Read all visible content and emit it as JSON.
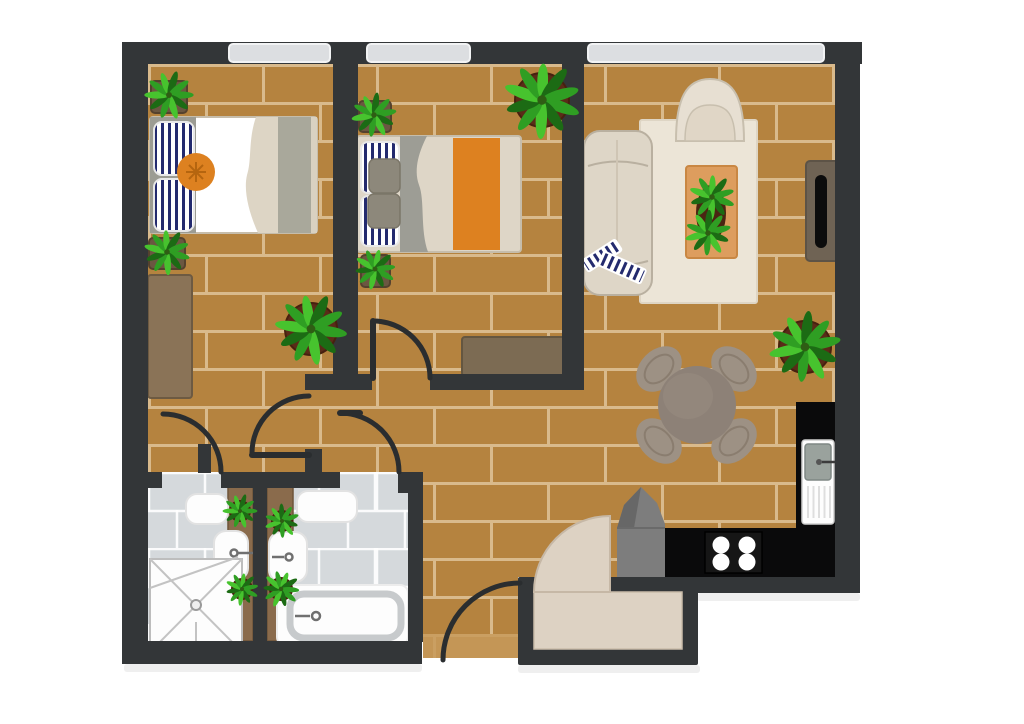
{
  "meta": {
    "title": "Apartment floor plan",
    "type": "top-down illustrated floor plan, no text labels",
    "canvas": {
      "width": 1024,
      "height": 724
    }
  },
  "colors": {
    "wall": "#333638",
    "doorArc": "#2a2d2f",
    "counter": "#0a0a0b",
    "floor": "#b5833f",
    "grout": "#d9ba8c",
    "entryPatch": "#c79a5b",
    "tile": "#d5d9dc",
    "tileLine": "#ffffff",
    "window": "#dcdee1",
    "cream": "#ded6c7",
    "creamLight": "#ece5d7",
    "beige": "#ddd2c3",
    "navy": "#232a6e",
    "orange": "#dd8120",
    "orangeDark": "#b5650f",
    "grayBand": "#a9a89b",
    "headboard": "#9c9c93",
    "bedGray": "#9d9d95",
    "squarePillow": "#8d887b",
    "woodDark": "#6f6354",
    "woodMid": "#7c6b53",
    "woodDresser": "#8a7357",
    "woodStrip": "#8a6b4c",
    "tableTop": "#8d8177",
    "chair": "#9d9184",
    "chairLine": "#8a7d6f",
    "potBrown": "#6b5741",
    "potClay": "#5a2b18",
    "leafDark": "#1c6b14",
    "leafMid": "#2f9e23",
    "leafLight": "#47c32e",
    "steel": "#9aa29d",
    "grayObject": "#7d7d7d",
    "grayObjectDark": "#676767",
    "tubLine": "#c7cacc",
    "shadow": "#e2e2e2"
  },
  "rooms": {
    "bedroom1": {
      "label": "Bedroom 1 (top left)",
      "furniture": [
        "double bed with striped pillows and orange round cushion",
        "dresser",
        "2 potted plants",
        "floor plant"
      ]
    },
    "bedroom2": {
      "label": "Bedroom 2 (top middle)",
      "furniture": [
        "double bed with striped pillows, two gray cushions and orange runner",
        "sideboard",
        "3 potted plants"
      ]
    },
    "living_room": {
      "label": "Living room (right)",
      "furniture": [
        "sofa with striped throw",
        "dome armchair",
        "rug",
        "coffee table with 2 plants",
        "tv console",
        "wall plant"
      ]
    },
    "dining_area": {
      "label": "Dining area",
      "furniture": [
        "round table",
        "4 oval chairs"
      ]
    },
    "kitchen": {
      "label": "Kitchen (bottom right)",
      "furniture": [
        "black L-shaped counter",
        "sink with drainboard",
        "4-burner stove",
        "gray standing object"
      ]
    },
    "bathroom1": {
      "label": "Bathroom 1 (shower)",
      "furniture": [
        "corner shower with drain",
        "washbasin",
        "shelf",
        "wood counter strip with 2 plants"
      ]
    },
    "bathroom2": {
      "label": "Bathroom 2 (bathtub)",
      "furniture": [
        "bathtub",
        "washbasin",
        "shelf",
        "wood counter strip with 2 plants"
      ]
    },
    "hallway": {
      "label": "Hallway"
    },
    "entry": {
      "label": "Entry vestibule",
      "furniture": [
        "doormat",
        "open front door leaf"
      ]
    }
  },
  "counts": {
    "windows": 3,
    "interior_door_arcs": 5,
    "front_door": 1,
    "plants": 13,
    "stove_burners": 4
  }
}
